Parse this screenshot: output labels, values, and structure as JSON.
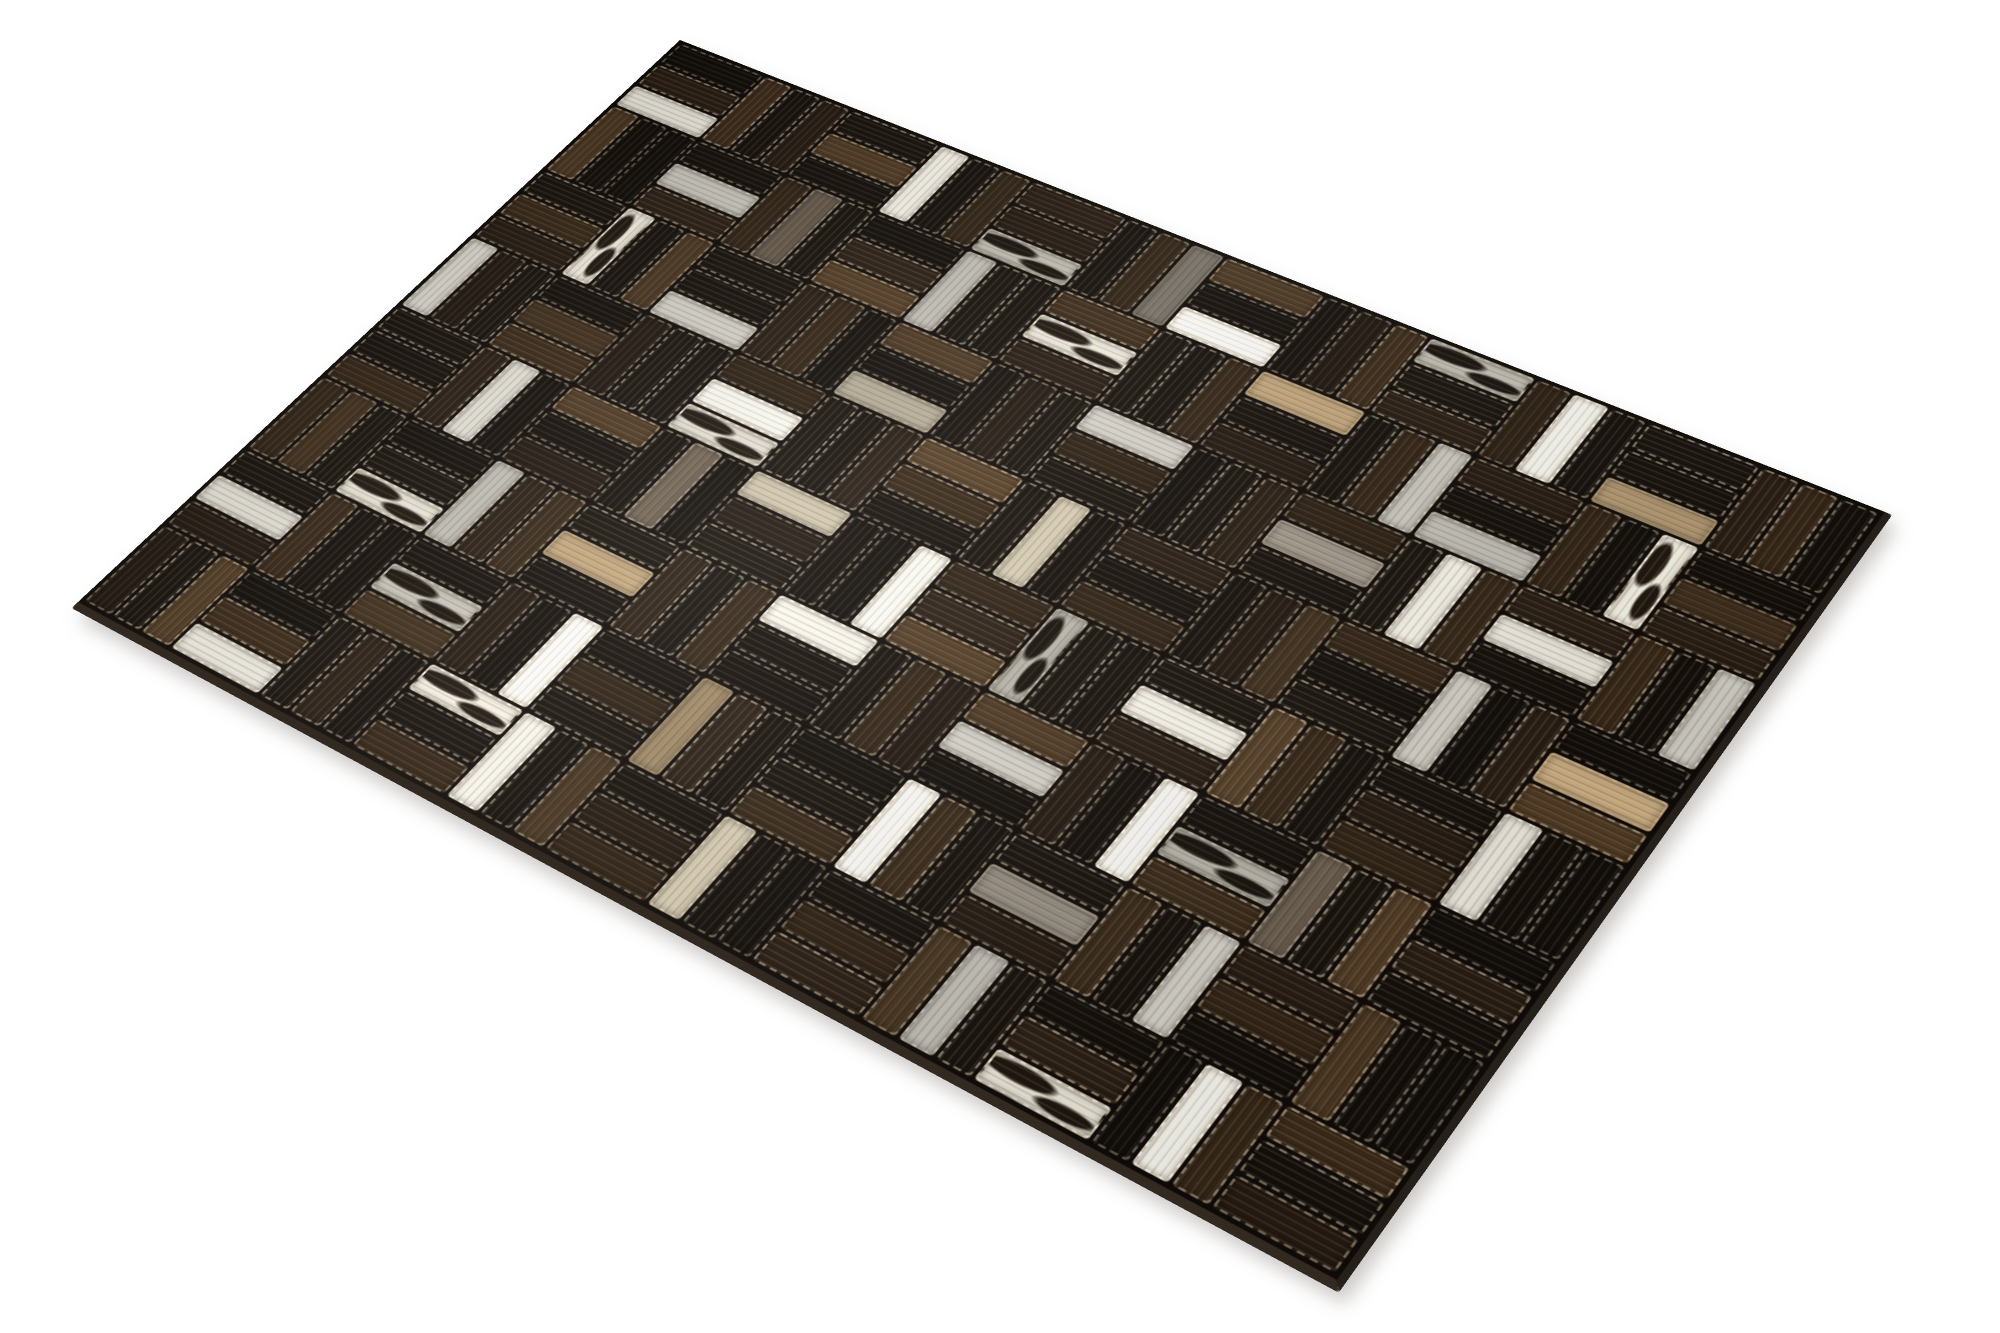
{
  "scene": {
    "type": "product-photo",
    "background_color": "#ffffff",
    "subject": "Rectangular hair-on cowhide patchwork rug photographed at a three-quarter angle on a plain white background"
  },
  "rug": {
    "material": "stitched hair-on cowhide leather patches",
    "pattern": "parquet basketweave of 3-strip blocks with alternating orientation",
    "stitching": "light tan zigzag thread around every patch",
    "stitch_color": "#e4d7b8",
    "seam_color": "#100b07",
    "edge_side_color": "#26201a",
    "edge_bottom_color": "#322a21",
    "shadow_color": "rgba(90,84,75,0.30)",
    "grid": {
      "cols": 12,
      "rows": 8,
      "strips_per_cell": 3
    },
    "corners_px": {
      "top": [
        680,
        40
      ],
      "right": [
        1885,
        512
      ],
      "bottom": [
        1337,
        1280
      ],
      "left": [
        78,
        602
      ]
    },
    "palette": [
      {
        "name": "black",
        "hex": "#16100a"
      },
      {
        "name": "ebony-brown",
        "hex": "#261b11"
      },
      {
        "name": "dark-brown",
        "hex": "#362616"
      },
      {
        "name": "chocolate",
        "hex": "#4e3922"
      },
      {
        "name": "taupe-brown",
        "hex": "#7c6c59"
      },
      {
        "name": "white",
        "hex": "#e9e5da"
      },
      {
        "name": "cream",
        "hex": "#d8cdb2"
      },
      {
        "name": "tan",
        "hex": "#b59a72"
      },
      {
        "name": "speckled-grey",
        "hex": "#90887b"
      },
      {
        "name": "black-white-spotted",
        "hex": "#ddd8ca",
        "spots": true,
        "spot_hex": "#1d150d"
      }
    ],
    "cells": [
      [
        [
          0,
          1,
          5
        ],
        [
          2,
          0,
          1
        ],
        [
          0,
          3,
          0
        ],
        [
          5,
          0,
          2
        ],
        [
          1,
          1,
          9
        ],
        [
          0,
          2,
          8
        ],
        [
          3,
          0,
          5
        ],
        [
          0,
          1,
          2
        ],
        [
          9,
          0,
          1
        ],
        [
          2,
          5,
          0
        ],
        [
          0,
          0,
          7
        ],
        [
          1,
          2,
          0
        ]
      ],
      [
        [
          3,
          0,
          0
        ],
        [
          0,
          5,
          1
        ],
        [
          2,
          4,
          0
        ],
        [
          0,
          1,
          3
        ],
        [
          5,
          0,
          0
        ],
        [
          2,
          9,
          1
        ],
        [
          0,
          0,
          2
        ],
        [
          7,
          0,
          1
        ],
        [
          0,
          2,
          5
        ],
        [
          1,
          0,
          5
        ],
        [
          2,
          0,
          9
        ],
        [
          0,
          3,
          1
        ]
      ],
      [
        [
          0,
          2,
          1
        ],
        [
          9,
          0,
          3
        ],
        [
          0,
          0,
          5
        ],
        [
          1,
          2,
          0
        ],
        [
          3,
          0,
          6
        ],
        [
          0,
          1,
          0
        ],
        [
          5,
          2,
          0
        ],
        [
          0,
          0,
          1
        ],
        [
          2,
          8,
          0
        ],
        [
          0,
          5,
          2
        ],
        [
          1,
          5,
          0
        ],
        [
          2,
          0,
          5
        ]
      ],
      [
        [
          5,
          1,
          0
        ],
        [
          0,
          3,
          2
        ],
        [
          1,
          0,
          0
        ],
        [
          2,
          5,
          9
        ],
        [
          0,
          0,
          1
        ],
        [
          3,
          2,
          0
        ],
        [
          0,
          6,
          0
        ],
        [
          1,
          0,
          2
        ],
        [
          0,
          1,
          3
        ],
        [
          2,
          0,
          0
        ],
        [
          5,
          0,
          1
        ],
        [
          0,
          7,
          3
        ]
      ],
      [
        [
          0,
          0,
          2
        ],
        [
          1,
          5,
          0
        ],
        [
          3,
          0,
          1
        ],
        [
          0,
          4,
          0
        ],
        [
          6,
          1,
          0
        ],
        [
          0,
          0,
          5
        ],
        [
          2,
          1,
          3
        ],
        [
          9,
          0,
          0
        ],
        [
          0,
          5,
          1
        ],
        [
          3,
          2,
          0
        ],
        [
          0,
          1,
          2
        ],
        [
          5,
          0,
          0
        ]
      ],
      [
        [
          2,
          3,
          0
        ],
        [
          0,
          0,
          9
        ],
        [
          5,
          1,
          2
        ],
        [
          0,
          7,
          0
        ],
        [
          1,
          0,
          2
        ],
        [
          5,
          0,
          0
        ],
        [
          0,
          2,
          1
        ],
        [
          3,
          5,
          0
        ],
        [
          1,
          0,
          5
        ],
        [
          0,
          9,
          2
        ],
        [
          4,
          0,
          3
        ],
        [
          0,
          1,
          0
        ]
      ],
      [
        [
          0,
          5,
          1
        ],
        [
          2,
          0,
          0
        ],
        [
          0,
          9,
          3
        ],
        [
          1,
          0,
          5
        ],
        [
          0,
          2,
          0
        ],
        [
          7,
          1,
          0
        ],
        [
          0,
          0,
          2
        ],
        [
          5,
          2,
          0
        ],
        [
          0,
          8,
          1
        ],
        [
          2,
          0,
          5
        ],
        [
          1,
          2,
          0
        ],
        [
          3,
          0,
          0
        ]
      ],
      [
        [
          1,
          0,
          3
        ],
        [
          0,
          2,
          5
        ],
        [
          0,
          1,
          0
        ],
        [
          9,
          0,
          2
        ],
        [
          5,
          0,
          3
        ],
        [
          0,
          1,
          2
        ],
        [
          6,
          0,
          0
        ],
        [
          0,
          2,
          1
        ],
        [
          3,
          5,
          0
        ],
        [
          0,
          1,
          9
        ],
        [
          0,
          5,
          2
        ],
        [
          2,
          0,
          1
        ]
      ]
    ]
  }
}
